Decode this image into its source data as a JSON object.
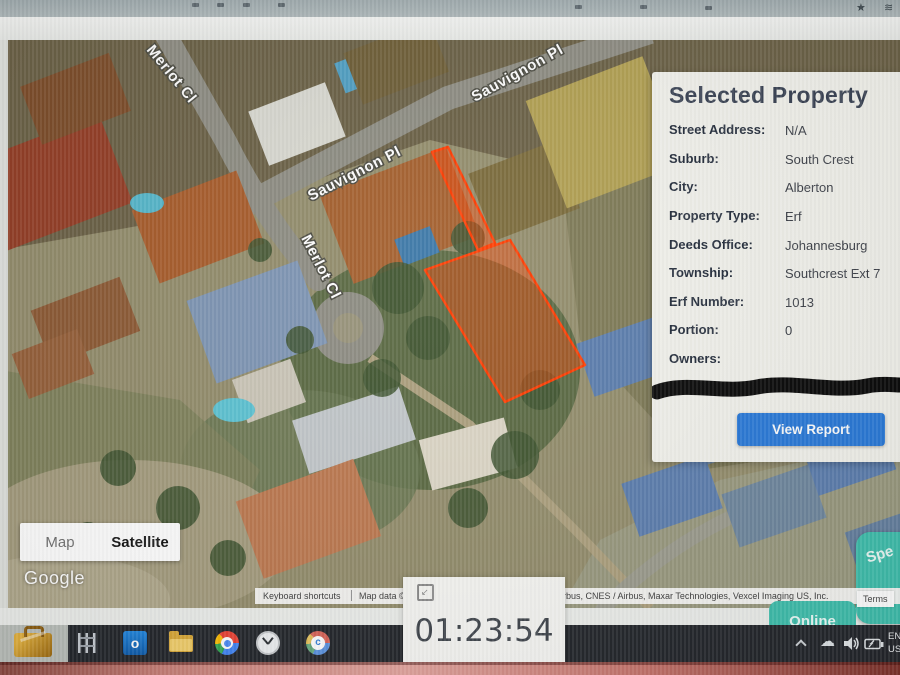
{
  "browser": {
    "bookmark_star": "★",
    "profile_mark": "≋"
  },
  "map": {
    "streets": {
      "merlot": "Merlot Cl",
      "sauvignon": "Sauvignon Pl"
    },
    "controls": {
      "map_label": "Map",
      "satellite_label": "Satellite"
    },
    "google_logo": "Google",
    "attribution": {
      "keyboard_shortcuts": "Keyboard shortcuts",
      "map_data": "Map data ©",
      "providers": "Airbus, CNES / Airbus, Maxar Technologies, Vexcel Imaging US, Inc.",
      "terms": "Terms"
    }
  },
  "panel": {
    "title": "Selected Property",
    "fields": [
      {
        "label": "Street Address:",
        "value": "N/A"
      },
      {
        "label": "Suburb:",
        "value": "South Crest"
      },
      {
        "label": "City:",
        "value": "Alberton"
      },
      {
        "label": "Property Type:",
        "value": "Erf"
      },
      {
        "label": "Deeds Office:",
        "value": "Johannesburg"
      },
      {
        "label": "Township:",
        "value": "Southcrest Ext 7"
      },
      {
        "label": "Erf Number:",
        "value": "1013"
      },
      {
        "label": "Portion:",
        "value": "0"
      },
      {
        "label": "Owners:",
        "value": ""
      }
    ],
    "view_report_label": "View Report"
  },
  "widgets": {
    "online_label": "Online",
    "side_button_label": "Spe",
    "timer": "01:23:54",
    "timer_resize_glyph": "↙"
  },
  "taskbar": {
    "outlook_glyph": "o",
    "tray_cloud_glyph": "☁",
    "language_line1": "EN",
    "language_line2": "US"
  },
  "colors": {
    "accent_blue": "#2a7ad9",
    "teal": "#3fbfad",
    "highlight_red": "#ff3c00",
    "taskbar_dark": "#24272c"
  }
}
